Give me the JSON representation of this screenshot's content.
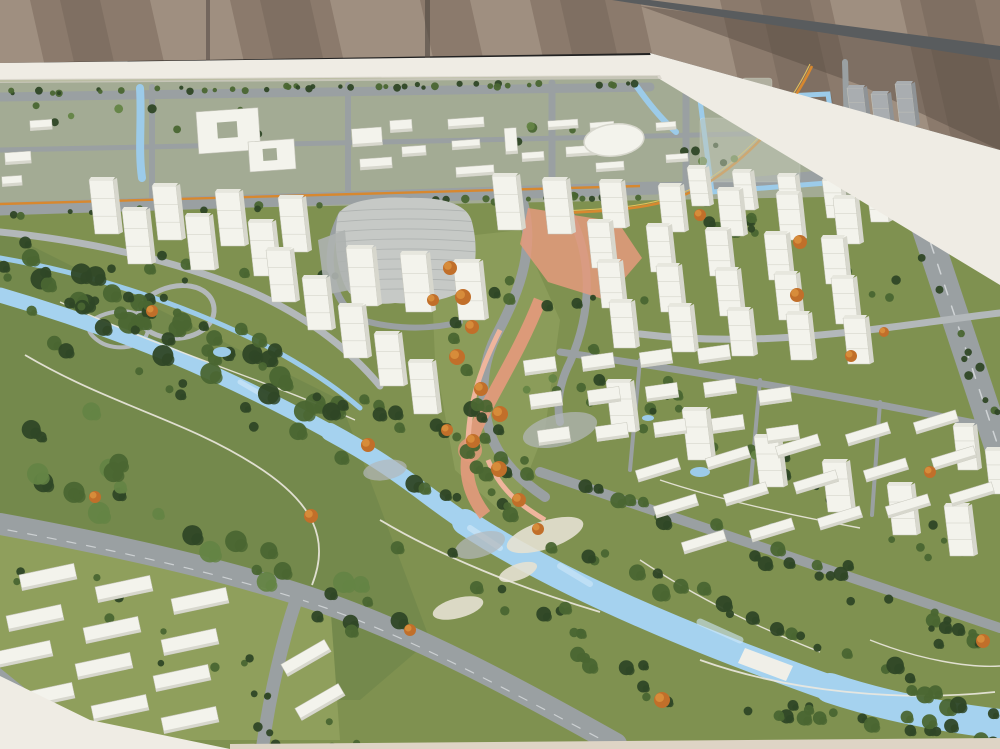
{
  "palette": {
    "wall_base": "#8b7a6c",
    "wall_light": "#c7b6a5",
    "wall_dark": "#675a4f",
    "wall_corner_dark": "#564a41",
    "rail_bar": "#595c5e",
    "seam": "#4e463f",
    "table_edge": "#efece4",
    "table_edge_shade": "#d4d0c6",
    "table_bottom": "#ded4c5",
    "grass": "#7f9150",
    "grass_light": "#8f9f5c",
    "park_green": "#73884b",
    "block_ground": "#a3ab94",
    "road": "#9aa0a2",
    "road_light": "#b3b8ba",
    "road_dark": "#82898d",
    "lane_mark": "#d8dcde",
    "river": "#a5d2ef",
    "river_light": "#cfe8f8",
    "pond": "#9ccbe9",
    "tree_dark": "#2f4726",
    "tree_mid": "#4a6631",
    "tree_light": "#648444",
    "tree_orange": "#c16f2a",
    "tree_orange2": "#d98f3c",
    "bldg_face": "#f3f3ec",
    "bldg_side": "#d7d7cd",
    "bldg_roof": "#e7e7de",
    "bldg_line": "#c6c6bb",
    "gray_face": "#a9adb0",
    "gray_side": "#8f9396",
    "translucent": "#c2c8b8",
    "landmark": "#c6c9c6",
    "landmark_line": "#aeb2b0",
    "salmon": "#e49a7c",
    "salmon_light": "#efb59c",
    "transit_orange": "#d7882f",
    "ribbon_yellow": "#e6c35a",
    "path_white": "#ece9df",
    "sand": "#e6e1d2",
    "bridge": "#f0efe8"
  },
  "wall_streaks": [
    {
      "x": -40,
      "w": 70,
      "tone": "light"
    },
    {
      "x": 60,
      "w": 40,
      "tone": "dark"
    },
    {
      "x": 150,
      "w": 80,
      "tone": "light"
    },
    {
      "x": 260,
      "w": 50,
      "tone": "dark"
    },
    {
      "x": 330,
      "w": 90,
      "tone": "light"
    },
    {
      "x": 470,
      "w": 60,
      "tone": "light"
    },
    {
      "x": 560,
      "w": 45,
      "tone": "dark"
    },
    {
      "x": 640,
      "w": 80,
      "tone": "light"
    },
    {
      "x": 760,
      "w": 50,
      "tone": "dark"
    },
    {
      "x": 830,
      "w": 70,
      "tone": "light"
    },
    {
      "x": 920,
      "w": 55,
      "tone": "dark"
    }
  ],
  "tower_clusters": [
    {
      "name": "avenue-row-west",
      "w": 24,
      "h": 54,
      "lean": 6,
      "bases": [
        [
          95,
          234
        ],
        [
          158,
          240
        ],
        [
          221,
          246
        ],
        [
          284,
          252
        ],
        [
          128,
          264
        ],
        [
          191,
          270
        ],
        [
          254,
          276
        ]
      ]
    },
    {
      "name": "avenue-row-east",
      "w": 24,
      "h": 54,
      "lean": 6,
      "bases": [
        [
          498,
          230
        ],
        [
          548,
          234
        ]
      ]
    },
    {
      "name": "front-of-landmark",
      "w": 26,
      "h": 58,
      "lean": 6,
      "bases": [
        [
          352,
          306
        ],
        [
          406,
          312
        ],
        [
          459,
          320
        ]
      ]
    },
    {
      "name": "band-b",
      "w": 24,
      "h": 52,
      "lean": 6,
      "bases": [
        [
          272,
          302
        ],
        [
          308,
          330
        ],
        [
          344,
          358
        ],
        [
          380,
          386
        ],
        [
          414,
          414
        ]
      ]
    },
    {
      "name": "grid-row0",
      "w": 18,
      "h": 38,
      "lean": 5,
      "bases": [
        [
          692,
          206
        ],
        [
          737,
          210
        ],
        [
          782,
          214
        ],
        [
          827,
          218
        ],
        [
          871,
          222
        ]
      ]
    },
    {
      "name": "grid-row1",
      "w": 22,
      "h": 46,
      "lean": 5,
      "bases": [
        [
          604,
          228
        ],
        [
          663,
          232
        ],
        [
          722,
          236
        ],
        [
          781,
          240
        ],
        [
          838,
          244
        ]
      ]
    },
    {
      "name": "grid-row2",
      "w": 22,
      "h": 46,
      "lean": 5,
      "bases": [
        [
          592,
          268
        ],
        [
          651,
          272
        ],
        [
          710,
          276
        ],
        [
          769,
          280
        ],
        [
          826,
          284
        ]
      ]
    },
    {
      "name": "grid-row3",
      "w": 22,
      "h": 46,
      "lean": 5,
      "bases": [
        [
          602,
          308
        ],
        [
          661,
          312
        ],
        [
          720,
          316
        ],
        [
          779,
          320
        ],
        [
          836,
          324
        ]
      ]
    },
    {
      "name": "grid-row4",
      "w": 22,
      "h": 46,
      "lean": 5,
      "bases": [
        [
          614,
          348
        ],
        [
          673,
          352
        ],
        [
          732,
          356
        ],
        [
          791,
          360
        ],
        [
          848,
          364
        ]
      ]
    },
    {
      "name": "river-row-c",
      "w": 24,
      "h": 50,
      "lean": 6,
      "bases": [
        [
          612,
          432
        ],
        [
          688,
          460
        ],
        [
          760,
          487
        ],
        [
          828,
          512
        ],
        [
          893,
          535
        ],
        [
          950,
          556
        ]
      ]
    },
    {
      "name": "far-right-pair",
      "w": 20,
      "h": 44,
      "lean": 5,
      "bases": [
        [
          958,
          470
        ],
        [
          990,
          494
        ]
      ]
    }
  ],
  "gray_towers": {
    "w": 16,
    "h": 42,
    "lean": 5,
    "bases": [
      [
        852,
        130
      ],
      [
        876,
        136
      ],
      [
        900,
        126
      ],
      [
        858,
        186
      ],
      [
        886,
        190
      ]
    ]
  },
  "midrise_clusters": [
    {
      "name": "center-grid",
      "w": 32,
      "h": 15,
      "angle": -8,
      "items": [
        [
          540,
          366
        ],
        [
          598,
          362
        ],
        [
          656,
          358
        ],
        [
          714,
          354
        ],
        [
          546,
          400
        ],
        [
          604,
          396
        ],
        [
          662,
          392
        ],
        [
          720,
          388
        ],
        [
          554,
          436
        ],
        [
          612,
          432
        ],
        [
          670,
          428
        ],
        [
          728,
          424
        ],
        [
          775,
          396
        ],
        [
          783,
          434
        ]
      ]
    },
    {
      "name": "riverside-rows",
      "w": 44,
      "h": 12,
      "angle": -17,
      "items": [
        [
          658,
          470
        ],
        [
          728,
          458
        ],
        [
          798,
          446
        ],
        [
          868,
          434
        ],
        [
          936,
          422
        ],
        [
          676,
          506
        ],
        [
          746,
          494
        ],
        [
          816,
          482
        ],
        [
          886,
          470
        ],
        [
          954,
          458
        ],
        [
          704,
          542
        ],
        [
          772,
          530
        ],
        [
          840,
          518
        ],
        [
          908,
          506
        ],
        [
          972,
          494
        ]
      ]
    }
  ],
  "lowrise_clusters": [
    {
      "name": "southwest-slabs",
      "w": 56,
      "h": 16,
      "angle": -12,
      "items": [
        [
          48,
          577
        ],
        [
          124,
          589
        ],
        [
          200,
          601
        ],
        [
          35,
          618
        ],
        [
          112,
          630
        ],
        [
          190,
          642
        ],
        [
          24,
          654
        ],
        [
          104,
          666
        ],
        [
          182,
          678
        ],
        [
          46,
          696
        ],
        [
          120,
          708
        ],
        [
          190,
          720
        ]
      ]
    },
    {
      "name": "southwest-east-slabs",
      "w": 50,
      "h": 14,
      "angle": -30,
      "items": [
        [
          306,
          658
        ],
        [
          320,
          702
        ]
      ]
    }
  ],
  "top_buildings": {
    "angle": -4,
    "items": [
      [
        352,
        128,
        30,
        18
      ],
      [
        390,
        120,
        22,
        12
      ],
      [
        360,
        158,
        32,
        11
      ],
      [
        402,
        146,
        24,
        10
      ],
      [
        448,
        118,
        36,
        10
      ],
      [
        452,
        140,
        28,
        9
      ],
      [
        456,
        166,
        38,
        10
      ],
      [
        505,
        128,
        12,
        26
      ],
      [
        522,
        152,
        22,
        9
      ],
      [
        548,
        120,
        30,
        9
      ],
      [
        566,
        146,
        30,
        10
      ],
      [
        590,
        122,
        24,
        8
      ],
      [
        596,
        162,
        28,
        9
      ],
      [
        656,
        122,
        20,
        8
      ],
      [
        666,
        154,
        22,
        8
      ],
      [
        5,
        152,
        26,
        12
      ],
      [
        2,
        176,
        20,
        10
      ],
      [
        30,
        120,
        22,
        10
      ]
    ]
  },
  "courtyard_buildings": [
    {
      "x": 196,
      "y": 112,
      "w": 62,
      "h": 42,
      "hx": 216,
      "hy": 124,
      "hw": 20,
      "hh": 16
    },
    {
      "x": 248,
      "y": 142,
      "w": 46,
      "h": 30,
      "hx": 262,
      "hy": 150,
      "hw": 14,
      "hh": 12
    }
  ],
  "oval_building": {
    "cx": 614,
    "cy": 140,
    "rx": 30,
    "ry": 16,
    "angle": -6
  },
  "translucent_blocks": [
    {
      "x": 700,
      "y": 118,
      "w": 100,
      "h": 64,
      "op": 0.5
    },
    {
      "x": 742,
      "y": 78,
      "w": 30,
      "h": 52,
      "op": 0.68
    },
    {
      "x": 776,
      "y": 96,
      "w": 24,
      "h": 44,
      "op": 0.62
    }
  ],
  "ponds": [
    [
      700,
      472,
      10,
      5
    ],
    [
      905,
      500,
      10,
      5
    ],
    [
      775,
      527,
      8,
      4
    ],
    [
      222,
      352,
      9,
      5
    ],
    [
      648,
      418,
      6,
      3
    ]
  ],
  "sand_patches": [
    [
      545,
      535,
      40,
      14,
      -18
    ],
    [
      458,
      608,
      26,
      10,
      -15
    ],
    [
      518,
      572,
      20,
      8,
      -20
    ]
  ],
  "plaza_patches": [
    [
      560,
      430,
      38,
      16,
      -14
    ],
    [
      480,
      545,
      26,
      12,
      -18
    ],
    [
      385,
      470,
      22,
      10,
      -10
    ]
  ],
  "bridge": {
    "points": "745,648 793,666 786,681 738,663"
  },
  "orange_trees": [
    [
      450,
      268,
      7
    ],
    [
      463,
      297,
      8
    ],
    [
      472,
      327,
      7
    ],
    [
      457,
      357,
      8
    ],
    [
      481,
      389,
      7
    ],
    [
      500,
      414,
      8
    ],
    [
      473,
      441,
      7
    ],
    [
      499,
      469,
      8
    ],
    [
      519,
      500,
      7
    ],
    [
      538,
      529,
      6
    ],
    [
      433,
      300,
      6
    ],
    [
      447,
      430,
      6
    ],
    [
      368,
      445,
      7
    ],
    [
      311,
      516,
      7
    ],
    [
      662,
      700,
      8
    ],
    [
      800,
      242,
      7
    ],
    [
      797,
      295,
      7
    ],
    [
      851,
      356,
      6
    ],
    [
      930,
      472,
      6
    ],
    [
      983,
      641,
      7
    ],
    [
      152,
      311,
      6
    ],
    [
      95,
      497,
      6
    ],
    [
      410,
      630,
      6
    ],
    [
      700,
      215,
      6
    ],
    [
      884,
      332,
      5
    ]
  ],
  "tree_bands": [
    {
      "seed": 1,
      "from": [
        10,
        92
      ],
      "to": [
        645,
        83
      ],
      "count": 46,
      "rmin": 2,
      "rmax": 4,
      "spread": 4,
      "colors": [
        "tree_mid",
        "tree_dark"
      ]
    },
    {
      "seed": 2,
      "from": [
        5,
        214
      ],
      "to": [
        648,
        196
      ],
      "count": 36,
      "rmin": 2.5,
      "rmax": 4.5,
      "spread": 5,
      "colors": [
        "tree_mid",
        "tree_dark"
      ]
    },
    {
      "seed": 3,
      "from": [
        20,
        110
      ],
      "to": [
        870,
        158
      ],
      "count": 30,
      "rmin": 2.5,
      "rmax": 5,
      "spread": 26,
      "colors": [
        "tree_mid",
        "tree_light",
        "tree_dark"
      ]
    },
    {
      "seed": 4,
      "from": [
        15,
        262
      ],
      "to": [
        370,
        418
      ],
      "count": 34,
      "rmin": 5,
      "rmax": 11,
      "spread": 46,
      "colors": [
        "tree_dark",
        "tree_mid"
      ]
    },
    {
      "seed": 5,
      "from": [
        25,
        432
      ],
      "to": [
        375,
        622
      ],
      "count": 30,
      "rmin": 5,
      "rmax": 11,
      "spread": 56,
      "colors": [
        "tree_dark",
        "tree_mid",
        "tree_light"
      ]
    },
    {
      "seed": 6,
      "from": [
        0,
        272
      ],
      "to": [
        1000,
        642
      ],
      "count": 44,
      "rmin": 4,
      "rmax": 8,
      "spread": 16,
      "colors": [
        "tree_dark",
        "tree_mid"
      ]
    },
    {
      "seed": 7,
      "from": [
        40,
        335
      ],
      "to": [
        1000,
        718
      ],
      "count": 40,
      "rmin": 4,
      "rmax": 9,
      "spread": 16,
      "colors": [
        "tree_dark",
        "tree_mid"
      ]
    },
    {
      "seed": 8,
      "from": [
        452,
        252
      ],
      "to": [
        500,
        516
      ],
      "count": 24,
      "rmin": 4,
      "rmax": 8,
      "spread": 16,
      "colors": [
        "tree_dark",
        "tree_mid"
      ]
    },
    {
      "seed": 9,
      "from": [
        120,
        262
      ],
      "to": [
        640,
        302
      ],
      "count": 22,
      "rmin": 3,
      "rmax": 6,
      "spread": 24,
      "colors": [
        "tree_mid",
        "tree_dark"
      ]
    },
    {
      "seed": 10,
      "from": [
        580,
        345
      ],
      "to": [
        950,
        555
      ],
      "count": 28,
      "rmin": 3,
      "rmax": 6,
      "spread": 38,
      "colors": [
        "tree_mid",
        "tree_dark"
      ]
    },
    {
      "seed": 11,
      "from": [
        640,
        692
      ],
      "to": [
        1000,
        738
      ],
      "count": 22,
      "rmin": 4,
      "rmax": 8,
      "spread": 16,
      "colors": [
        "tree_dark",
        "tree_mid"
      ]
    },
    {
      "seed": 12,
      "from": [
        10,
        560
      ],
      "to": [
        320,
        735
      ],
      "count": 20,
      "rmin": 3,
      "rmax": 5,
      "spread": 46,
      "colors": [
        "tree_mid",
        "tree_dark"
      ]
    },
    {
      "seed": 13,
      "from": [
        900,
        182
      ],
      "to": [
        995,
        420
      ],
      "count": 12,
      "rmin": 3,
      "rmax": 5,
      "spread": 9,
      "colors": [
        "tree_mid",
        "tree_dark"
      ]
    },
    {
      "seed": 14,
      "from": [
        540,
        382
      ],
      "to": [
        780,
        458
      ],
      "count": 14,
      "rmin": 3,
      "rmax": 5,
      "spread": 26,
      "colors": [
        "tree_mid",
        "tree_light"
      ]
    },
    {
      "seed": 15,
      "from": [
        700,
        202
      ],
      "to": [
        905,
        298
      ],
      "count": 16,
      "rmin": 3,
      "rmax": 6,
      "spread": 26,
      "colors": [
        "tree_mid",
        "tree_dark"
      ]
    },
    {
      "seed": 16,
      "from": [
        20,
        252
      ],
      "to": [
        300,
        380
      ],
      "count": 18,
      "rmin": 4,
      "rmax": 8,
      "spread": 28,
      "colors": [
        "tree_dark",
        "tree_mid"
      ]
    },
    {
      "seed": 17,
      "from": [
        390,
        540
      ],
      "to": [
        620,
        660
      ],
      "count": 16,
      "rmin": 4,
      "rmax": 8,
      "spread": 30,
      "colors": [
        "tree_dark",
        "tree_mid"
      ]
    },
    {
      "seed": 18,
      "from": [
        820,
        560
      ],
      "to": [
        1000,
        660
      ],
      "count": 12,
      "rmin": 3,
      "rmax": 6,
      "spread": 30,
      "colors": [
        "tree_mid",
        "tree_dark"
      ]
    }
  ]
}
